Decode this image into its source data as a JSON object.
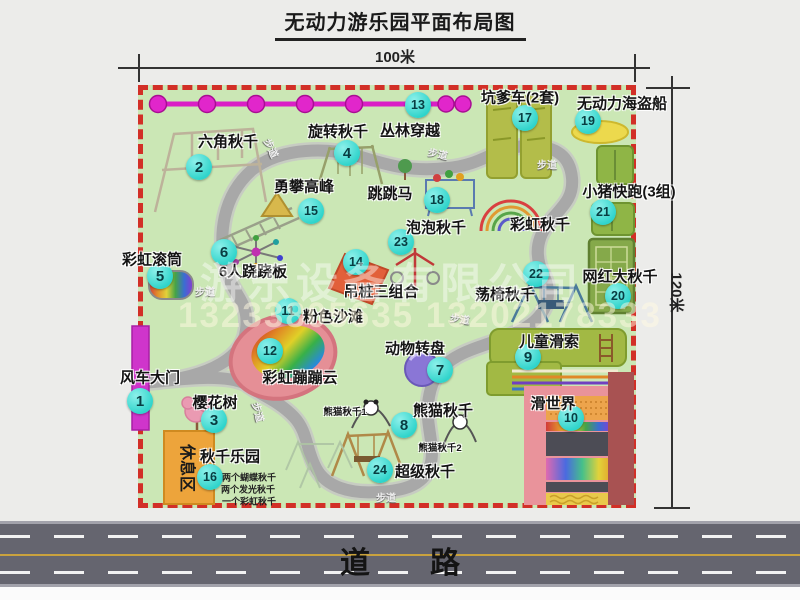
{
  "page": {
    "title": "无动力游乐园平面布局图"
  },
  "dimensions": {
    "top": "100米",
    "right": "120米"
  },
  "road": {
    "label": "道　　路"
  },
  "watermark": {
    "company": "游乐设备有限公司",
    "phone": "13233805635 13202178333"
  },
  "colors": {
    "park_fill": "#cbe7b5",
    "border_red": "#d22f27",
    "path_gray": "#a8a8a8",
    "badge_cyan": "#2fd4cb",
    "zipline_magenta": "#da1ec6",
    "gate_magenta": "#cf35cb",
    "rest_orange": "#eda43b",
    "road_gray": "#65656f"
  },
  "map": {
    "rest_area_label": "休息区",
    "badges": [
      {
        "n": "1",
        "x": 140,
        "y": 401
      },
      {
        "n": "2",
        "x": 199,
        "y": 167
      },
      {
        "n": "3",
        "x": 214,
        "y": 420
      },
      {
        "n": "4",
        "x": 347,
        "y": 153
      },
      {
        "n": "5",
        "x": 160,
        "y": 276
      },
      {
        "n": "6",
        "x": 224,
        "y": 252
      },
      {
        "n": "7",
        "x": 440,
        "y": 370
      },
      {
        "n": "8",
        "x": 404,
        "y": 425
      },
      {
        "n": "9",
        "x": 528,
        "y": 357
      },
      {
        "n": "10",
        "x": 571,
        "y": 418
      },
      {
        "n": "11",
        "x": 288,
        "y": 311
      },
      {
        "n": "12",
        "x": 270,
        "y": 351
      },
      {
        "n": "13",
        "x": 418,
        "y": 105
      },
      {
        "n": "14",
        "x": 356,
        "y": 262
      },
      {
        "n": "15",
        "x": 311,
        "y": 211
      },
      {
        "n": "16",
        "x": 210,
        "y": 477
      },
      {
        "n": "17",
        "x": 525,
        "y": 118
      },
      {
        "n": "18",
        "x": 437,
        "y": 200
      },
      {
        "n": "19",
        "x": 588,
        "y": 121
      },
      {
        "n": "20",
        "x": 618,
        "y": 296
      },
      {
        "n": "21",
        "x": 603,
        "y": 212
      },
      {
        "n": "22",
        "x": 536,
        "y": 274
      },
      {
        "n": "23",
        "x": 401,
        "y": 242
      },
      {
        "n": "24",
        "x": 380,
        "y": 470
      }
    ],
    "labels": [
      {
        "text": "风车大门",
        "x": 150,
        "y": 377
      },
      {
        "text": "六角秋千",
        "x": 228,
        "y": 141
      },
      {
        "text": "旋转秋千",
        "x": 338,
        "y": 131
      },
      {
        "text": "丛林穿越",
        "x": 410,
        "y": 130
      },
      {
        "text": "坑爹车(2套)",
        "x": 520,
        "y": 97
      },
      {
        "text": "无动力海盗船",
        "x": 622,
        "y": 103
      },
      {
        "text": "小猪快跑(3组)",
        "x": 629,
        "y": 191
      },
      {
        "text": "勇攀高峰",
        "x": 304,
        "y": 186
      },
      {
        "text": "跳跳马",
        "x": 390,
        "y": 193
      },
      {
        "text": "泡泡秋千",
        "x": 436,
        "y": 227
      },
      {
        "text": "彩虹秋千",
        "x": 540,
        "y": 224
      },
      {
        "text": "彩虹滚筒",
        "x": 152,
        "y": 259
      },
      {
        "text": "6人跷跷板",
        "x": 253,
        "y": 271
      },
      {
        "text": "吊桩三组合",
        "x": 381,
        "y": 291
      },
      {
        "text": "荡椅秋千",
        "x": 505,
        "y": 294
      },
      {
        "text": "网红大秋千",
        "x": 620,
        "y": 276
      },
      {
        "text": "粉色沙滩",
        "x": 333,
        "y": 316
      },
      {
        "text": "儿童滑索",
        "x": 549,
        "y": 341
      },
      {
        "text": "动物转盘",
        "x": 415,
        "y": 348
      },
      {
        "text": "滑世界",
        "x": 553,
        "y": 403
      },
      {
        "text": "熊猫秋千",
        "x": 443,
        "y": 410
      },
      {
        "text": "樱花树",
        "x": 215,
        "y": 402
      },
      {
        "text": "彩虹蹦蹦云",
        "x": 300,
        "y": 377
      },
      {
        "text": "超级秋千",
        "x": 425,
        "y": 471
      },
      {
        "text": "秋千乐园",
        "x": 230,
        "y": 456
      },
      {
        "text": "熊猫秋千1",
        "x": 345,
        "y": 411,
        "cls": "sub"
      },
      {
        "text": "熊猫秋千2",
        "x": 440,
        "y": 447,
        "cls": "sub"
      },
      {
        "text": "两个蝴蝶秋千",
        "x": 249,
        "y": 477,
        "cls": "note"
      },
      {
        "text": "两个发光秋千",
        "x": 248,
        "y": 489,
        "cls": "note"
      },
      {
        "text": "一个彩虹秋千",
        "x": 249,
        "y": 501,
        "cls": "note"
      },
      {
        "text": "步道",
        "x": 272,
        "y": 148,
        "cls": "path",
        "rot": 65
      },
      {
        "text": "步道",
        "x": 438,
        "y": 153,
        "cls": "path",
        "rot": 12
      },
      {
        "text": "步道",
        "x": 547,
        "y": 164,
        "cls": "path"
      },
      {
        "text": "步道",
        "x": 205,
        "y": 291,
        "cls": "path"
      },
      {
        "text": "步道",
        "x": 460,
        "y": 318,
        "cls": "path",
        "rot": 8
      },
      {
        "text": "步道",
        "x": 259,
        "y": 412,
        "cls": "path",
        "rot": 75
      },
      {
        "text": "步道",
        "x": 386,
        "y": 497,
        "cls": "path"
      }
    ]
  }
}
